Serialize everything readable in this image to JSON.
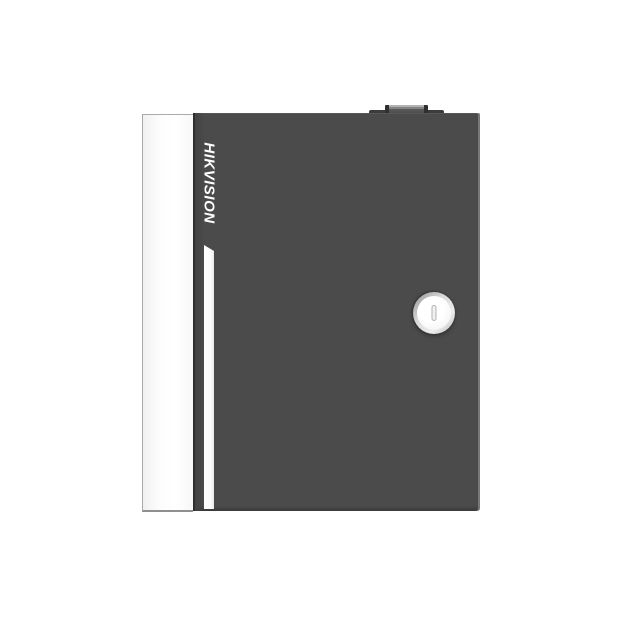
{
  "device": {
    "brand_label": "HIKVISION"
  },
  "colors": {
    "bg": "#ffffff",
    "door": "#4b4b4b",
    "door-left-shade": "#424242",
    "seam": "#2d2d2d",
    "panel": "#fcfcfc",
    "panel-border": "#aaaaaa",
    "panel-bottom": "#8f8f8f",
    "stripe": "#fbfbfb",
    "hinge-base": "#3b3b3b",
    "hinge-face": "#848484",
    "hinge-highlight": "#b2b2b2",
    "hinge-end": "#2f2f2f",
    "lock-rim-dark": "#909090",
    "lock-rim-light": "#ececec",
    "lock-face": "#f7f7f7",
    "slot-border": "#b3b3b3",
    "slot-fill": "#f0f0f0"
  }
}
